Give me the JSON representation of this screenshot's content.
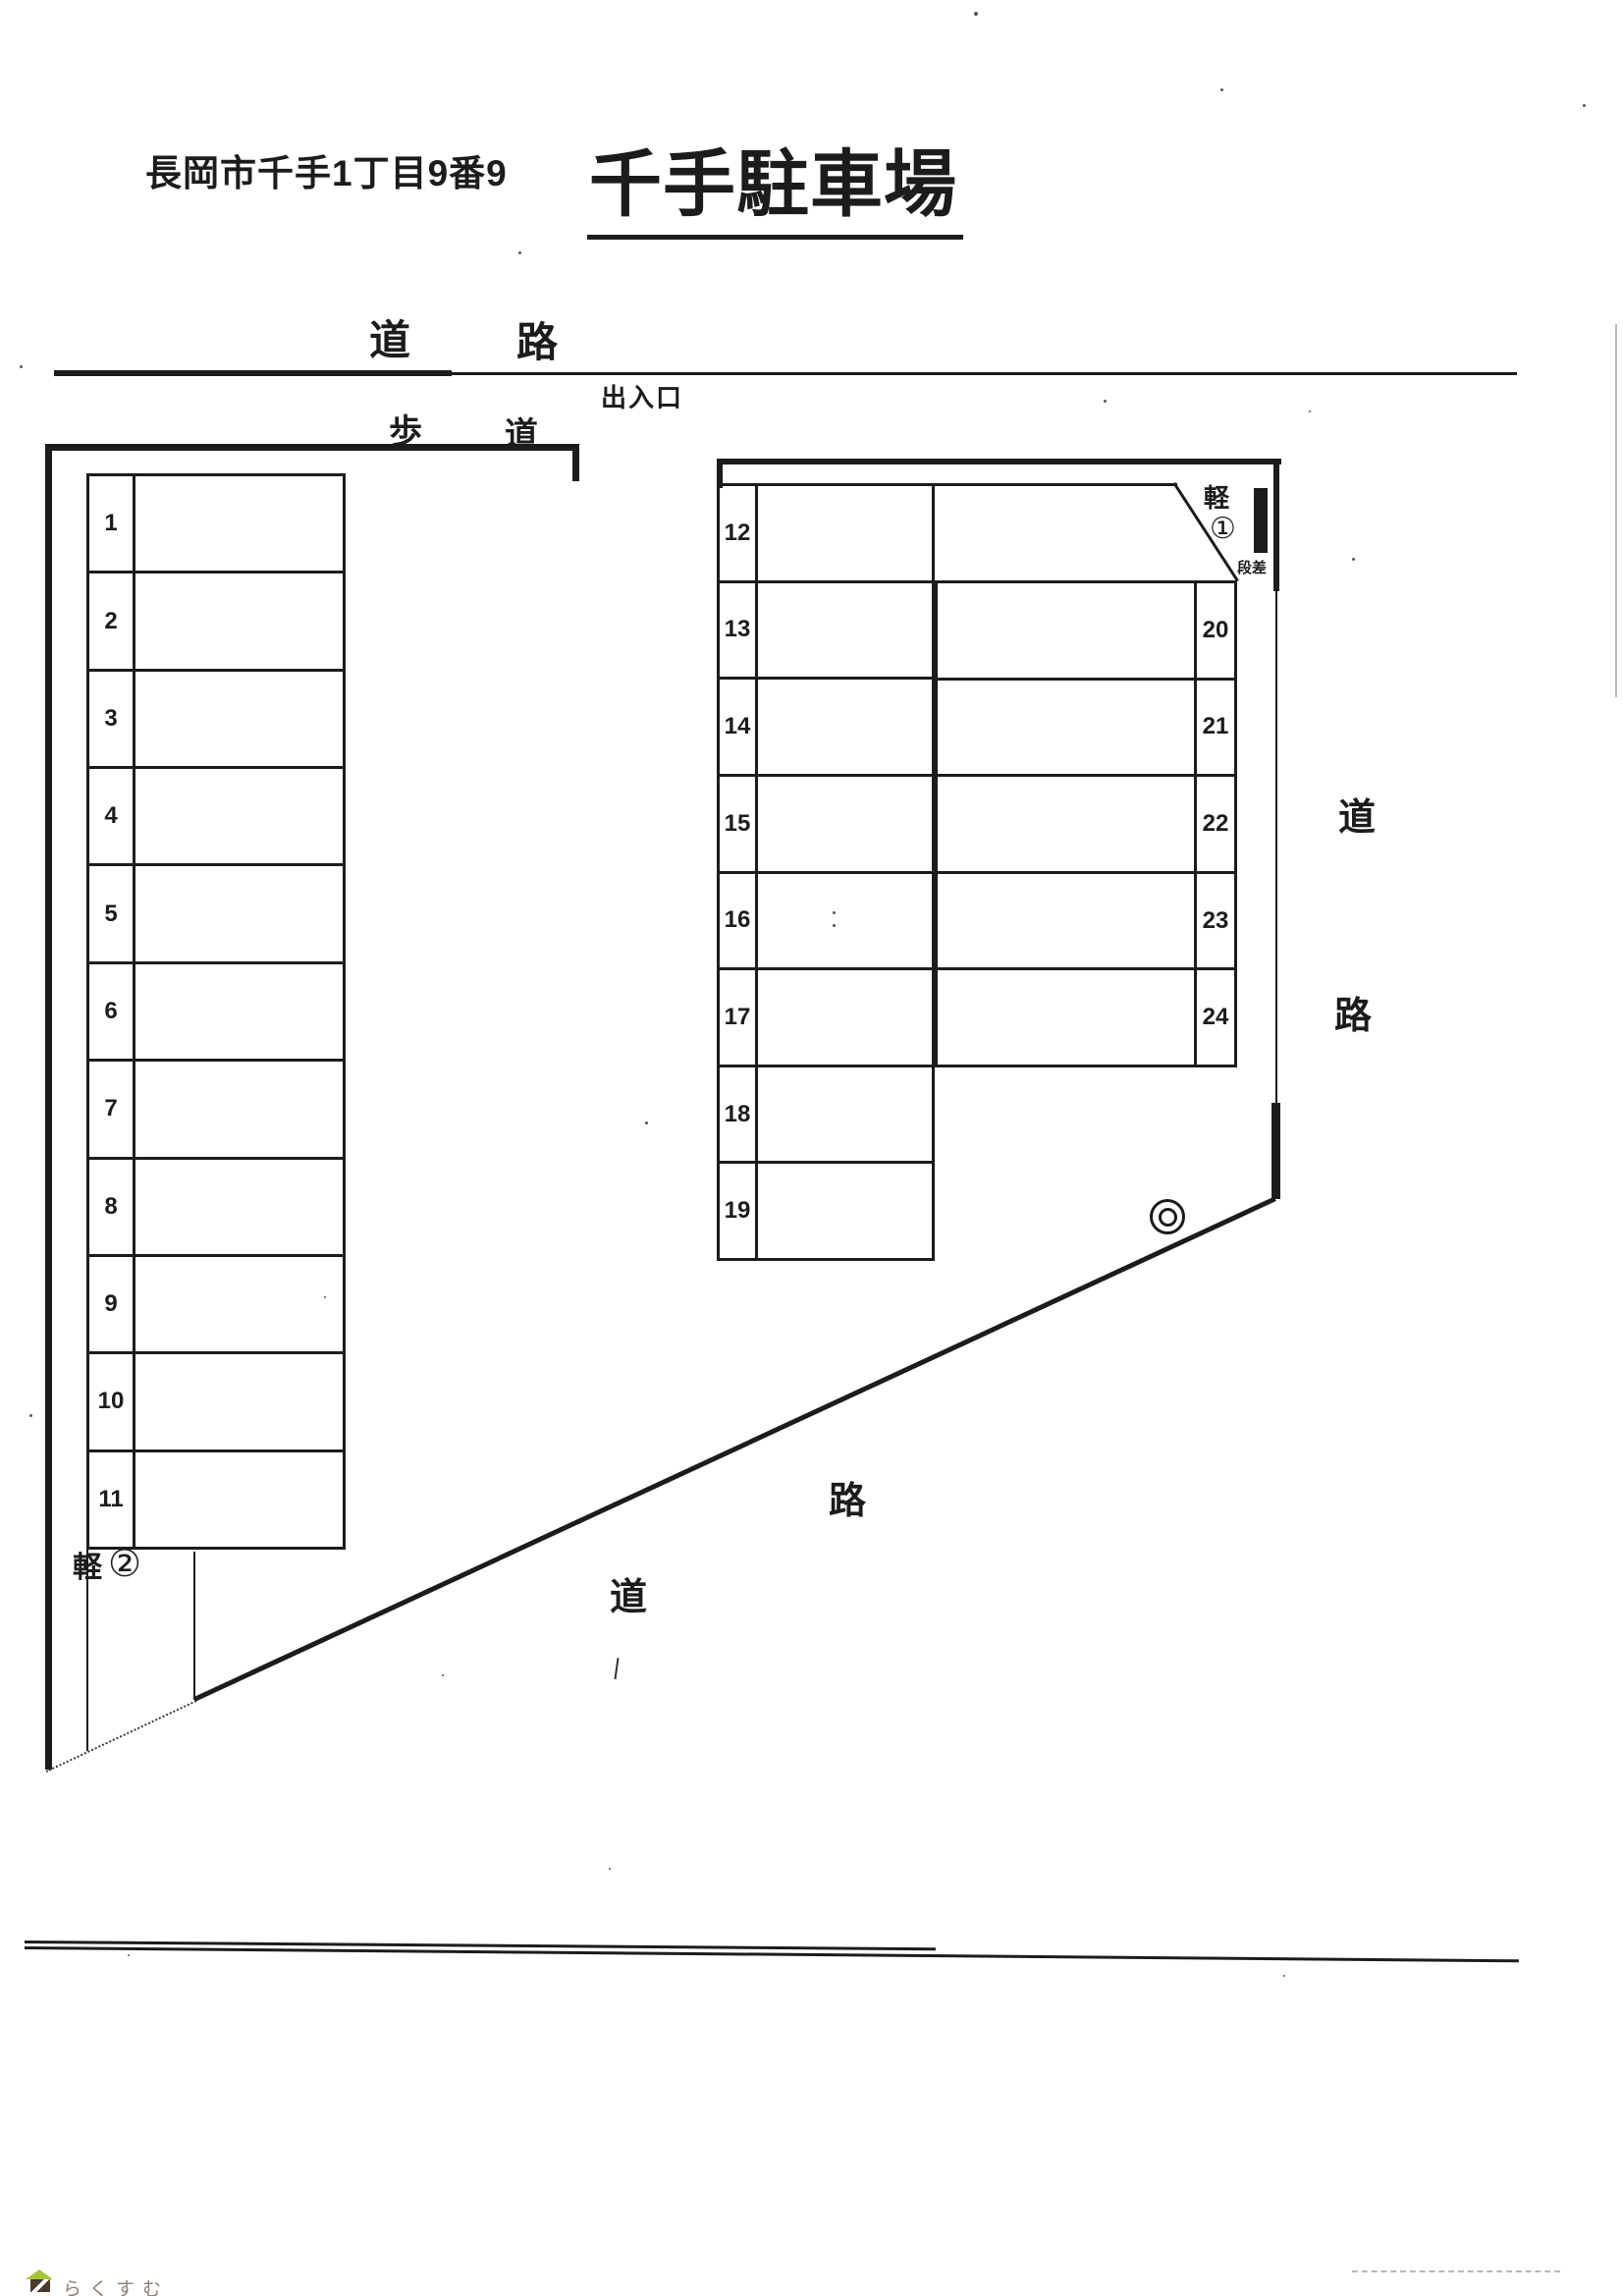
{
  "header": {
    "address": "長岡市千手1丁目9番9",
    "title": "千手駐車場"
  },
  "labels": {
    "road_top": [
      "道",
      "路"
    ],
    "sidewalk": [
      "歩",
      "道"
    ],
    "entrance": "出入口",
    "road_right": [
      "道",
      "路"
    ],
    "road_bottom": [
      "道",
      "路"
    ],
    "light_car_1": {
      "kei": "軽",
      "num": "①"
    },
    "light_car_2": {
      "kei": "軽",
      "num": "②"
    },
    "step": "段差"
  },
  "parking": {
    "left_column": {
      "spaces": [
        "1",
        "2",
        "3",
        "4",
        "5",
        "6",
        "7",
        "8",
        "9",
        "10",
        "11"
      ]
    },
    "middle_column": {
      "spaces": [
        "12",
        "13",
        "14",
        "15",
        "16",
        "17",
        "18",
        "19"
      ]
    },
    "right_column": {
      "spaces": [
        "20",
        "21",
        "22",
        "23",
        "24"
      ]
    }
  },
  "watermark": {
    "text": "らくすむ"
  },
  "colors": {
    "line": "#1c1c1c",
    "watermark_roof": "#a5c63b",
    "watermark_body": "#4a3a30",
    "watermark_text": "#8d8275"
  }
}
